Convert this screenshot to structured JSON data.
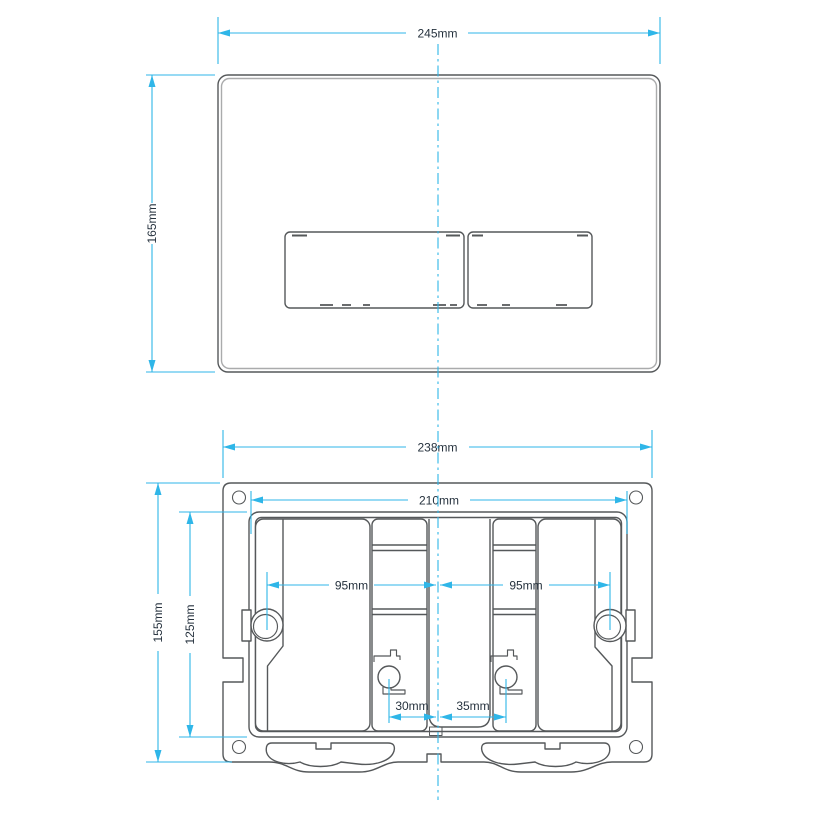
{
  "colors": {
    "dim": "#2fb6e8",
    "art": "#55585a",
    "text": "#26323e",
    "bg": "#ffffff"
  },
  "front_view": {
    "width_label": "245mm",
    "height_label": "165mm"
  },
  "back_view": {
    "outer_width_label": "238mm",
    "inner_width_label": "210mm",
    "outer_height_label": "155mm",
    "inner_height_label": "125mm",
    "left_spacing_label": "95mm",
    "right_spacing_label": "95mm",
    "left_rod_offset_label": "30mm",
    "right_rod_offset_label": "35mm"
  }
}
